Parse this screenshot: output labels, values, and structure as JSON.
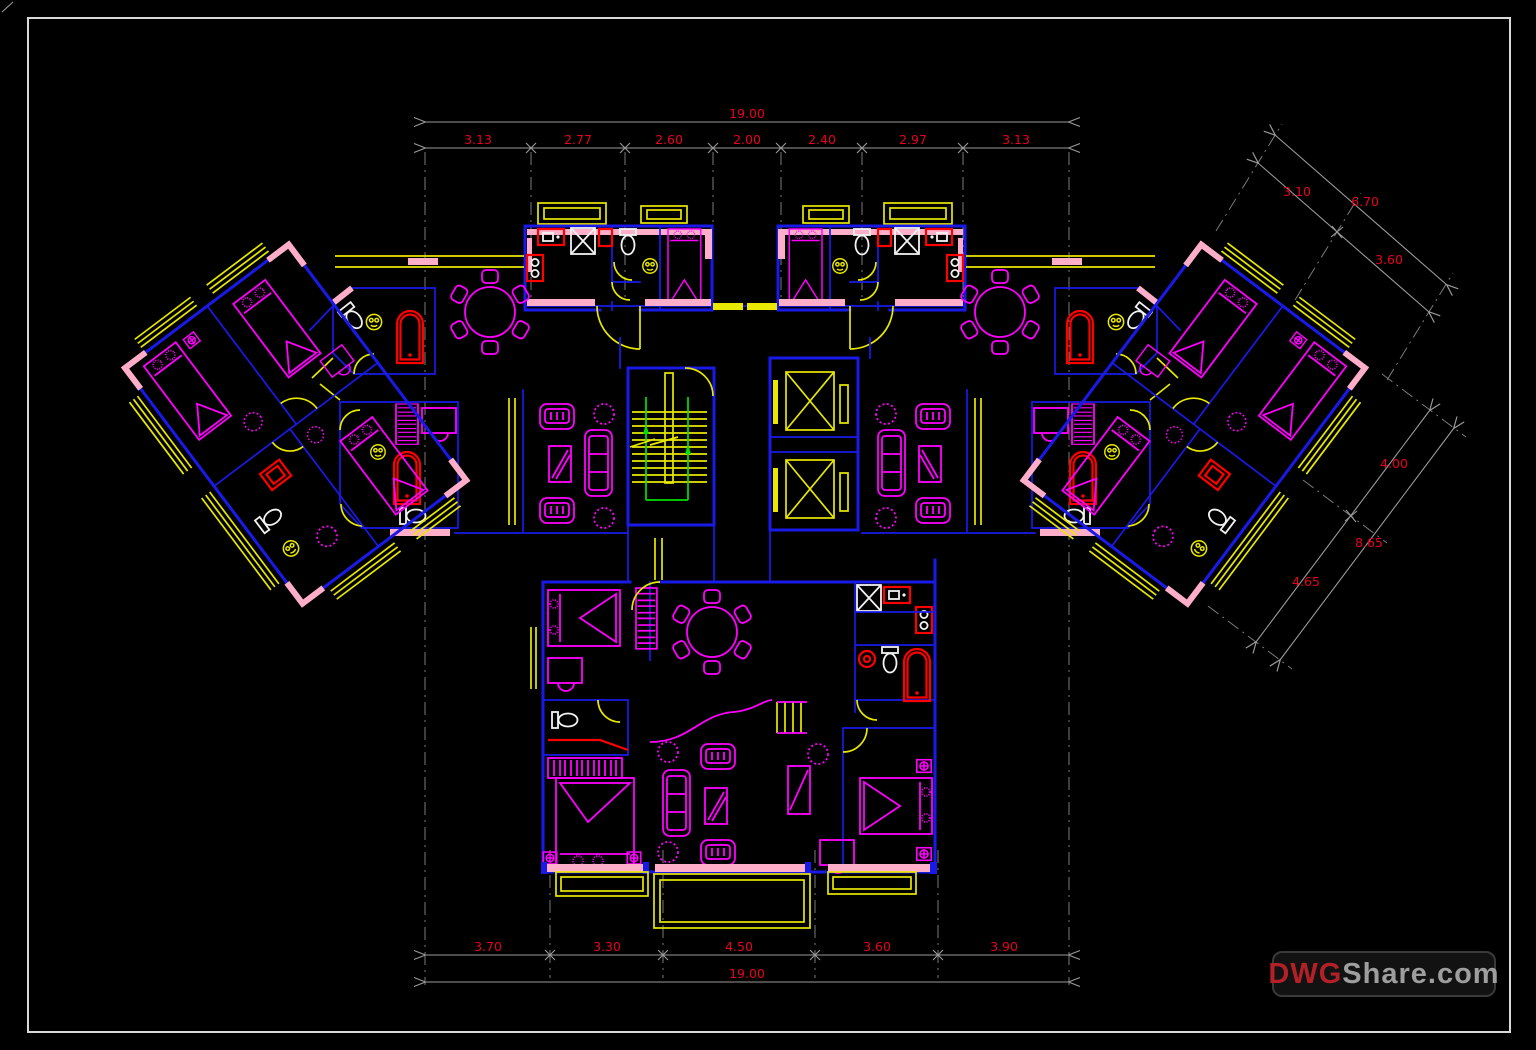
{
  "dimensions": {
    "top": {
      "overall": "19.00",
      "segments": [
        "3.13",
        "2.77",
        "2.60",
        "2.00",
        "2.40",
        "2.97",
        "3.13"
      ]
    },
    "bottom": {
      "overall": "19.00",
      "segments": [
        "3.70",
        "3.30",
        "4.50",
        "3.60",
        "3.90"
      ]
    },
    "right_upper": {
      "overall": "6.70",
      "segments": [
        "3.10",
        "3.60"
      ]
    },
    "right_lower": {
      "overall": "8.65",
      "segments": [
        "4.00",
        "4.65"
      ]
    }
  },
  "watermark": {
    "prefix": "DWG",
    "suffix": "Share.com"
  },
  "colors": {
    "bg": "#000000",
    "frame": "#d9d9d9",
    "wall": "#1a1ae8",
    "window": "#e8e800",
    "furniture": "#ff00ff",
    "fixture": "#ff0000",
    "pink": "#ffaec9",
    "green": "#00e000",
    "dimline": "#9a9a9a",
    "dimtext": "#e8001e",
    "fixwhite": "#f2f2f2",
    "wm_red": "#b22028",
    "wm_gray": "#9e9e9e",
    "wm_border": "#3a3a3a",
    "wm_bg": "#121212"
  }
}
